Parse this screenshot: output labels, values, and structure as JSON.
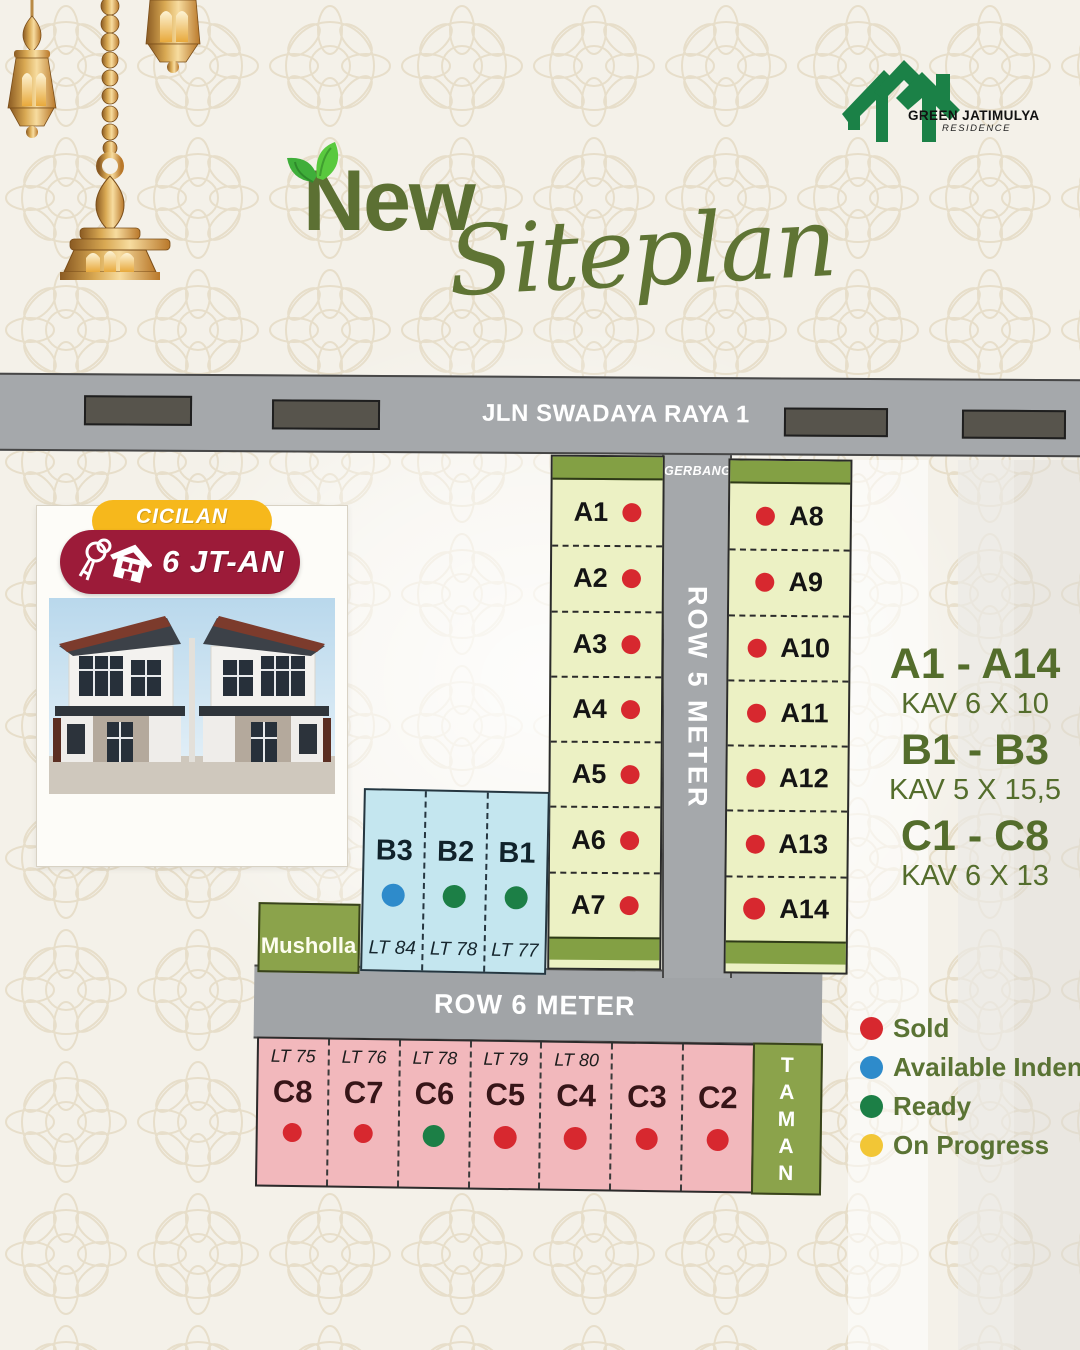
{
  "brand": {
    "name": "GREEN JATIMULYA",
    "sub": "RESIDENCE"
  },
  "title": {
    "word1": "New",
    "word2": "Siteplan"
  },
  "roads": {
    "main": "JLN SWADAYA RAYA 1",
    "gate": "GERBANG",
    "row5": "ROW 5 METER",
    "row6": "ROW 6 METER"
  },
  "promo": {
    "badge_top": "CICILAN",
    "badge_bottom": "6 JT-AN"
  },
  "areas": {
    "musholla": "Musholla",
    "taman": "T\nA\nM\nA\nN"
  },
  "lots": {
    "a_left": [
      {
        "id": "A1",
        "status": "sold"
      },
      {
        "id": "A2",
        "status": "sold"
      },
      {
        "id": "A3",
        "status": "sold"
      },
      {
        "id": "A4",
        "status": "sold"
      },
      {
        "id": "A5",
        "status": "sold"
      },
      {
        "id": "A6",
        "status": "sold"
      },
      {
        "id": "A7",
        "status": "sold"
      }
    ],
    "a_right": [
      {
        "id": "A8",
        "status": "sold"
      },
      {
        "id": "A9",
        "status": "sold"
      },
      {
        "id": "A10",
        "status": "sold"
      },
      {
        "id": "A11",
        "status": "sold"
      },
      {
        "id": "A12",
        "status": "sold"
      },
      {
        "id": "A13",
        "status": "sold"
      },
      {
        "id": "A14",
        "status": "sold"
      }
    ],
    "b": [
      {
        "id": "B3",
        "lt": "LT 84",
        "status": "available-indent"
      },
      {
        "id": "B2",
        "lt": "LT 78",
        "status": "ready"
      },
      {
        "id": "B1",
        "lt": "LT 77",
        "status": "ready"
      }
    ],
    "c": [
      {
        "id": "C8",
        "lt": "LT 75",
        "status": "sold"
      },
      {
        "id": "C7",
        "lt": "LT 76",
        "status": "sold"
      },
      {
        "id": "C6",
        "lt": "LT 78",
        "status": "ready"
      },
      {
        "id": "C5",
        "lt": "LT 79",
        "status": "sold"
      },
      {
        "id": "C4",
        "lt": "LT 80",
        "status": "sold"
      },
      {
        "id": "C3",
        "lt": "",
        "status": "sold"
      },
      {
        "id": "C2",
        "lt": "",
        "status": "sold"
      }
    ]
  },
  "info": [
    {
      "range": "A1 - A14",
      "size": "KAV 6 X 10"
    },
    {
      "range": "B1 - B3",
      "size": "KAV 5 X 15,5"
    },
    {
      "range": "C1 - C8",
      "size": "KAV 6 X 13"
    }
  ],
  "legend": [
    {
      "label": "Sold",
      "status": "sold"
    },
    {
      "label": "Available Indent",
      "status": "available-indent"
    },
    {
      "label": "Ready",
      "status": "ready"
    },
    {
      "label": "On Progress",
      "status": "on-progress"
    }
  ],
  "status_colors": {
    "sold": "#d7282f",
    "available-indent": "#2e8bcb",
    "ready": "#1c7f46",
    "on-progress": "#f2c636"
  }
}
